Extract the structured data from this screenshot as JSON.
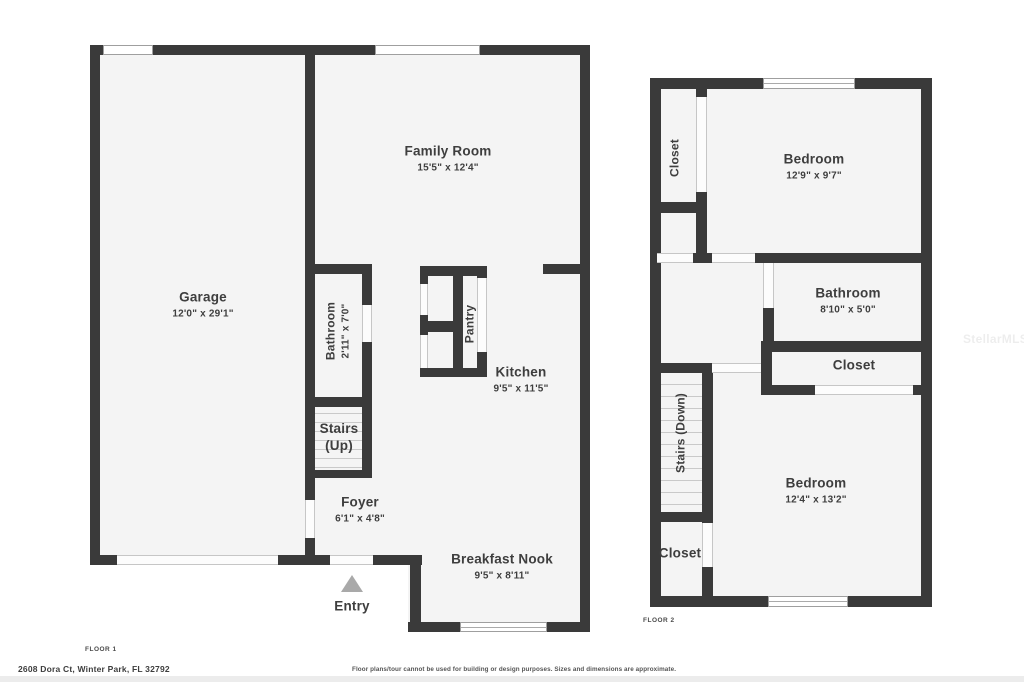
{
  "floor1": {
    "floor_label": "FLOOR 1",
    "rooms": {
      "garage": {
        "name": "Garage",
        "dims": "12'0\" x 29'1\""
      },
      "family_room": {
        "name": "Family Room",
        "dims": "15'5\" x 12'4\""
      },
      "bathroom": {
        "name": "Bathroom",
        "dims": "2'11\" x 7'0\""
      },
      "pantry": {
        "name": "Pantry"
      },
      "kitchen": {
        "name": "Kitchen",
        "dims": "9'5\" x 11'5\""
      },
      "stairs": {
        "line1": "Stairs",
        "line2": "(Up)"
      },
      "foyer": {
        "name": "Foyer",
        "dims": "6'1\" x 4'8\""
      },
      "breakfast_nook": {
        "name": "Breakfast Nook",
        "dims": "9'5\" x 8'11\""
      }
    },
    "entry_label": "Entry"
  },
  "floor2": {
    "floor_label": "FLOOR 2",
    "rooms": {
      "closet_upper": {
        "name": "Closet"
      },
      "bedroom_front": {
        "name": "Bedroom",
        "dims": "12'9\" x 9'7\""
      },
      "bathroom": {
        "name": "Bathroom",
        "dims": "8'10\" x 5'0\""
      },
      "closet_middle": {
        "name": "Closet"
      },
      "stairs": {
        "name": "Stairs (Down)"
      },
      "bedroom_rear": {
        "name": "Bedroom",
        "dims": "12'4\" x 13'2\""
      },
      "closet_lower": {
        "name": "Closet"
      }
    }
  },
  "footer": {
    "address": "2608 Dora Ct, Winter Park, FL 32792",
    "disclaimer": "Floor plans/tour cannot be used for building or design purposes. Sizes and dimensions are approximate."
  },
  "watermark": "StellarMLS",
  "colors": {
    "wall": "#3a3a3a",
    "room_fill": "#f4f4f4",
    "label_text": "#3e3e3e",
    "entry_arrow": "#a9a9a9",
    "stair_tread": "#c9c9c9"
  }
}
